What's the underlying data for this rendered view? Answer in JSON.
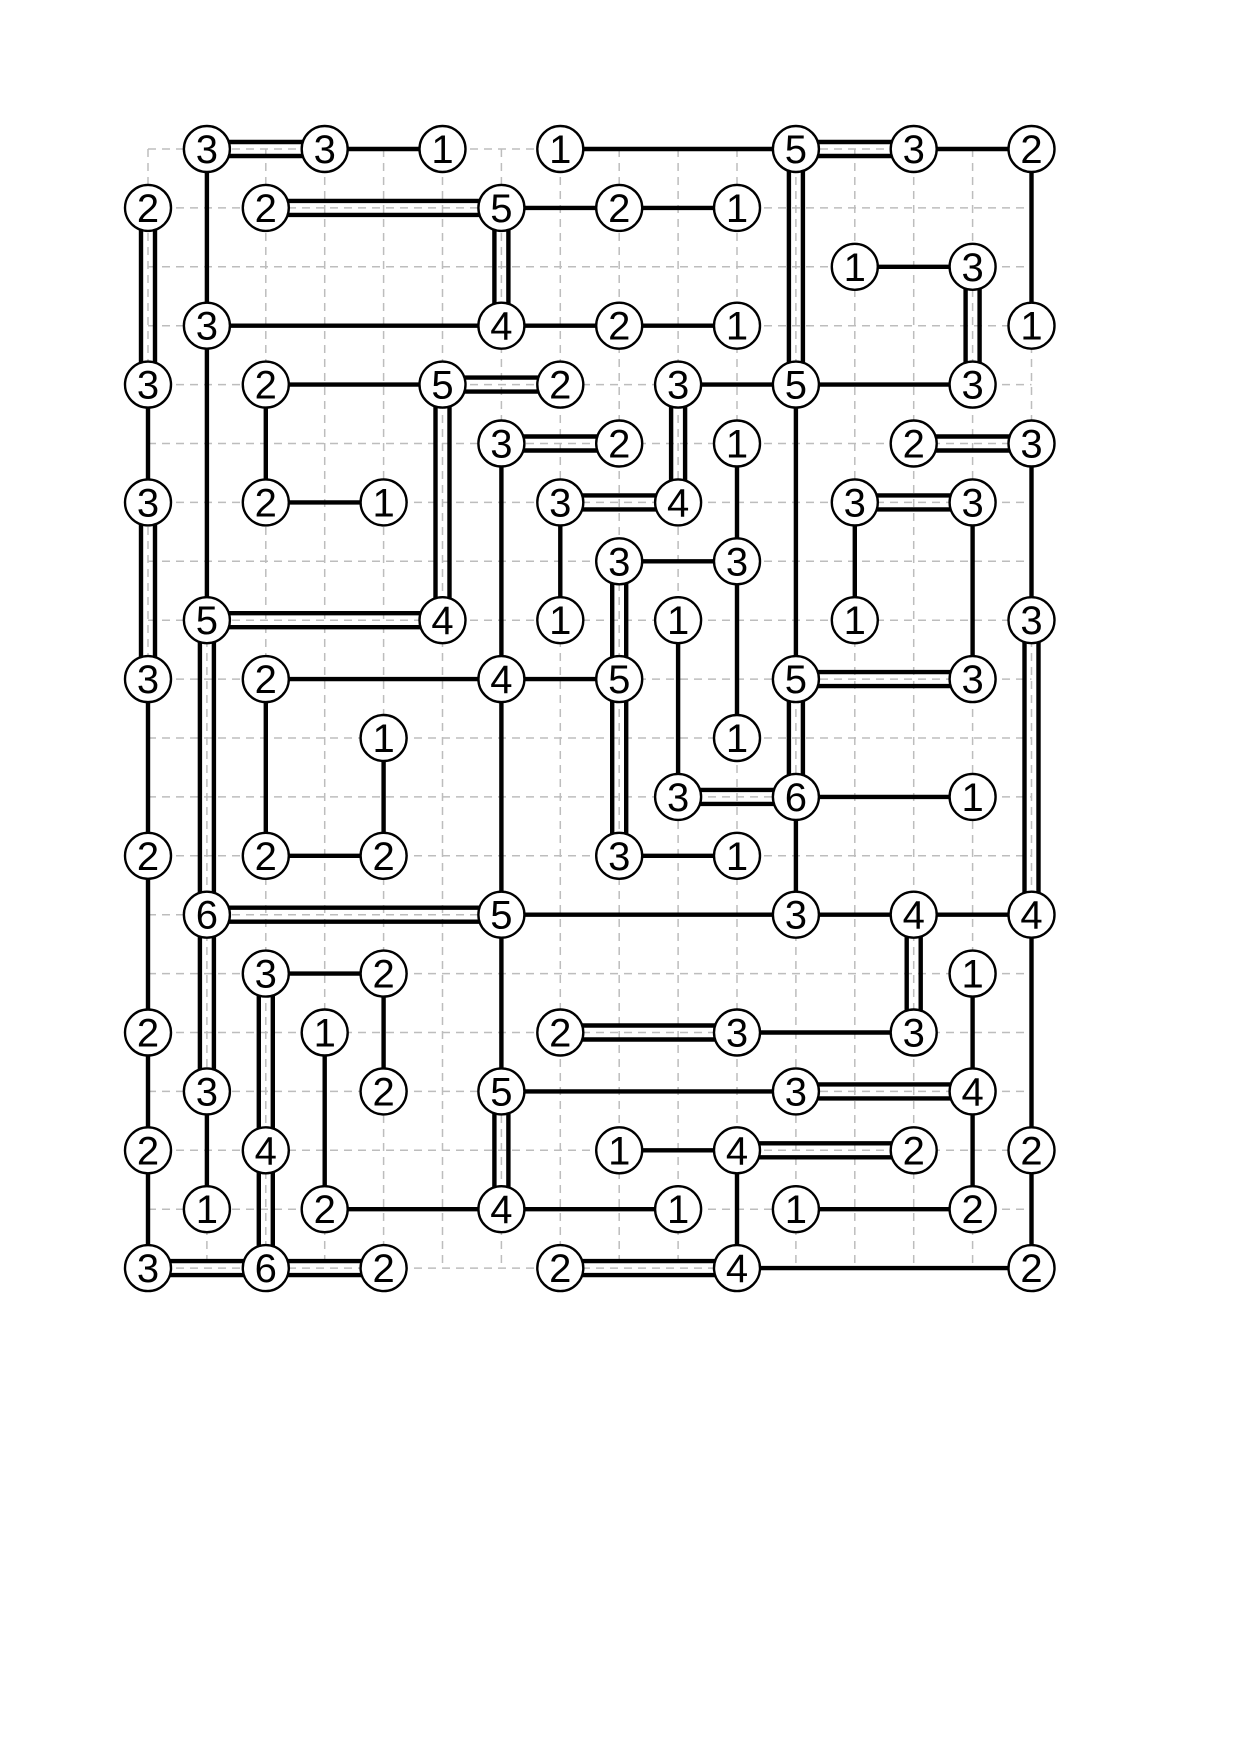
{
  "canvas": {
    "width": 1240,
    "height": 1754,
    "background": "#ffffff"
  },
  "puzzle": {
    "type": "hashiwokakero-bridges-solved",
    "grid": {
      "cols": 16,
      "rows": 20,
      "origin_x": 148,
      "origin_y": 149,
      "cell": 58.9
    },
    "style": {
      "node_fill": "#ffffff",
      "node_stroke": "#000000",
      "node_stroke_width": 2.4,
      "node_radius": 23,
      "digit_color": "#000000",
      "digit_size": 40,
      "bridge_color": "#000000",
      "bridge_width": 4.4,
      "double_gap": 14,
      "grid_color": "#bdbdbd",
      "grid_width": 1.5,
      "grid_dash": "8 6"
    },
    "nodes": [
      {
        "c": 1,
        "r": 0,
        "v": "3"
      },
      {
        "c": 3,
        "r": 0,
        "v": "3"
      },
      {
        "c": 5,
        "r": 0,
        "v": "1"
      },
      {
        "c": 7,
        "r": 0,
        "v": "1"
      },
      {
        "c": 11,
        "r": 0,
        "v": "5"
      },
      {
        "c": 13,
        "r": 0,
        "v": "3"
      },
      {
        "c": 15,
        "r": 0,
        "v": "2"
      },
      {
        "c": 0,
        "r": 1,
        "v": "2"
      },
      {
        "c": 2,
        "r": 1,
        "v": "2"
      },
      {
        "c": 6,
        "r": 1,
        "v": "5"
      },
      {
        "c": 8,
        "r": 1,
        "v": "2"
      },
      {
        "c": 10,
        "r": 1,
        "v": "1"
      },
      {
        "c": 12,
        "r": 2,
        "v": "1"
      },
      {
        "c": 14,
        "r": 2,
        "v": "3"
      },
      {
        "c": 1,
        "r": 3,
        "v": "3"
      },
      {
        "c": 6,
        "r": 3,
        "v": "4"
      },
      {
        "c": 8,
        "r": 3,
        "v": "2"
      },
      {
        "c": 10,
        "r": 3,
        "v": "1"
      },
      {
        "c": 15,
        "r": 3,
        "v": "1"
      },
      {
        "c": 0,
        "r": 4,
        "v": "3"
      },
      {
        "c": 2,
        "r": 4,
        "v": "2"
      },
      {
        "c": 5,
        "r": 4,
        "v": "5"
      },
      {
        "c": 7,
        "r": 4,
        "v": "2"
      },
      {
        "c": 9,
        "r": 4,
        "v": "3"
      },
      {
        "c": 11,
        "r": 4,
        "v": "5"
      },
      {
        "c": 14,
        "r": 4,
        "v": "3"
      },
      {
        "c": 6,
        "r": 5,
        "v": "3"
      },
      {
        "c": 8,
        "r": 5,
        "v": "2"
      },
      {
        "c": 10,
        "r": 5,
        "v": "1"
      },
      {
        "c": 13,
        "r": 5,
        "v": "2"
      },
      {
        "c": 15,
        "r": 5,
        "v": "3"
      },
      {
        "c": 0,
        "r": 6,
        "v": "3"
      },
      {
        "c": 2,
        "r": 6,
        "v": "2"
      },
      {
        "c": 4,
        "r": 6,
        "v": "1"
      },
      {
        "c": 7,
        "r": 6,
        "v": "3"
      },
      {
        "c": 9,
        "r": 6,
        "v": "4"
      },
      {
        "c": 12,
        "r": 6,
        "v": "3"
      },
      {
        "c": 14,
        "r": 6,
        "v": "3"
      },
      {
        "c": 8,
        "r": 7,
        "v": "3"
      },
      {
        "c": 10,
        "r": 7,
        "v": "3"
      },
      {
        "c": 1,
        "r": 8,
        "v": "5"
      },
      {
        "c": 5,
        "r": 8,
        "v": "4"
      },
      {
        "c": 7,
        "r": 8,
        "v": "1"
      },
      {
        "c": 9,
        "r": 8,
        "v": "1"
      },
      {
        "c": 12,
        "r": 8,
        "v": "1"
      },
      {
        "c": 15,
        "r": 8,
        "v": "3"
      },
      {
        "c": 0,
        "r": 9,
        "v": "3"
      },
      {
        "c": 2,
        "r": 9,
        "v": "2"
      },
      {
        "c": 6,
        "r": 9,
        "v": "4"
      },
      {
        "c": 8,
        "r": 9,
        "v": "5"
      },
      {
        "c": 11,
        "r": 9,
        "v": "5"
      },
      {
        "c": 14,
        "r": 9,
        "v": "3"
      },
      {
        "c": 4,
        "r": 10,
        "v": "1"
      },
      {
        "c": 10,
        "r": 10,
        "v": "1"
      },
      {
        "c": 9,
        "r": 11,
        "v": "3"
      },
      {
        "c": 11,
        "r": 11,
        "v": "6"
      },
      {
        "c": 14,
        "r": 11,
        "v": "1"
      },
      {
        "c": 0,
        "r": 12,
        "v": "2"
      },
      {
        "c": 2,
        "r": 12,
        "v": "2"
      },
      {
        "c": 4,
        "r": 12,
        "v": "2"
      },
      {
        "c": 8,
        "r": 12,
        "v": "3"
      },
      {
        "c": 10,
        "r": 12,
        "v": "1"
      },
      {
        "c": 1,
        "r": 13,
        "v": "6"
      },
      {
        "c": 6,
        "r": 13,
        "v": "5"
      },
      {
        "c": 11,
        "r": 13,
        "v": "3"
      },
      {
        "c": 13,
        "r": 13,
        "v": "4"
      },
      {
        "c": 15,
        "r": 13,
        "v": "4"
      },
      {
        "c": 2,
        "r": 14,
        "v": "3"
      },
      {
        "c": 4,
        "r": 14,
        "v": "2"
      },
      {
        "c": 14,
        "r": 14,
        "v": "1"
      },
      {
        "c": 0,
        "r": 15,
        "v": "2"
      },
      {
        "c": 3,
        "r": 15,
        "v": "1"
      },
      {
        "c": 7,
        "r": 15,
        "v": "2"
      },
      {
        "c": 10,
        "r": 15,
        "v": "3"
      },
      {
        "c": 13,
        "r": 15,
        "v": "3"
      },
      {
        "c": 1,
        "r": 16,
        "v": "3"
      },
      {
        "c": 4,
        "r": 16,
        "v": "2"
      },
      {
        "c": 6,
        "r": 16,
        "v": "5"
      },
      {
        "c": 11,
        "r": 16,
        "v": "3"
      },
      {
        "c": 14,
        "r": 16,
        "v": "4"
      },
      {
        "c": 0,
        "r": 17,
        "v": "2"
      },
      {
        "c": 2,
        "r": 17,
        "v": "4"
      },
      {
        "c": 8,
        "r": 17,
        "v": "1"
      },
      {
        "c": 10,
        "r": 17,
        "v": "4"
      },
      {
        "c": 13,
        "r": 17,
        "v": "2"
      },
      {
        "c": 15,
        "r": 17,
        "v": "2"
      },
      {
        "c": 1,
        "r": 18,
        "v": "1"
      },
      {
        "c": 3,
        "r": 18,
        "v": "2"
      },
      {
        "c": 6,
        "r": 18,
        "v": "4"
      },
      {
        "c": 9,
        "r": 18,
        "v": "1"
      },
      {
        "c": 11,
        "r": 18,
        "v": "1"
      },
      {
        "c": 14,
        "r": 18,
        "v": "2"
      },
      {
        "c": 0,
        "r": 19,
        "v": "3"
      },
      {
        "c": 2,
        "r": 19,
        "v": "6"
      },
      {
        "c": 4,
        "r": 19,
        "v": "2"
      },
      {
        "c": 7,
        "r": 19,
        "v": "2"
      },
      {
        "c": 10,
        "r": 19,
        "v": "4"
      },
      {
        "c": 15,
        "r": 19,
        "v": "2"
      }
    ],
    "bridges": [
      {
        "x1": 1,
        "y1": 0,
        "x2": 3,
        "y2": 0,
        "n": 2
      },
      {
        "x1": 3,
        "y1": 0,
        "x2": 5,
        "y2": 0,
        "n": 1
      },
      {
        "x1": 7,
        "y1": 0,
        "x2": 11,
        "y2": 0,
        "n": 1
      },
      {
        "x1": 11,
        "y1": 0,
        "x2": 13,
        "y2": 0,
        "n": 2
      },
      {
        "x1": 13,
        "y1": 0,
        "x2": 15,
        "y2": 0,
        "n": 1
      },
      {
        "x1": 2,
        "y1": 1,
        "x2": 6,
        "y2": 1,
        "n": 2
      },
      {
        "x1": 6,
        "y1": 1,
        "x2": 8,
        "y2": 1,
        "n": 1
      },
      {
        "x1": 8,
        "y1": 1,
        "x2": 10,
        "y2": 1,
        "n": 1
      },
      {
        "x1": 12,
        "y1": 2,
        "x2": 14,
        "y2": 2,
        "n": 1
      },
      {
        "x1": 1,
        "y1": 3,
        "x2": 6,
        "y2": 3,
        "n": 1
      },
      {
        "x1": 6,
        "y1": 3,
        "x2": 8,
        "y2": 3,
        "n": 1
      },
      {
        "x1": 8,
        "y1": 3,
        "x2": 10,
        "y2": 3,
        "n": 1
      },
      {
        "x1": 2,
        "y1": 4,
        "x2": 5,
        "y2": 4,
        "n": 1
      },
      {
        "x1": 5,
        "y1": 4,
        "x2": 7,
        "y2": 4,
        "n": 2
      },
      {
        "x1": 9,
        "y1": 4,
        "x2": 11,
        "y2": 4,
        "n": 1
      },
      {
        "x1": 11,
        "y1": 4,
        "x2": 14,
        "y2": 4,
        "n": 1
      },
      {
        "x1": 6,
        "y1": 5,
        "x2": 8,
        "y2": 5,
        "n": 2
      },
      {
        "x1": 13,
        "y1": 5,
        "x2": 15,
        "y2": 5,
        "n": 2
      },
      {
        "x1": 2,
        "y1": 6,
        "x2": 4,
        "y2": 6,
        "n": 1
      },
      {
        "x1": 7,
        "y1": 6,
        "x2": 9,
        "y2": 6,
        "n": 2
      },
      {
        "x1": 12,
        "y1": 6,
        "x2": 14,
        "y2": 6,
        "n": 2
      },
      {
        "x1": 8,
        "y1": 7,
        "x2": 10,
        "y2": 7,
        "n": 1
      },
      {
        "x1": 1,
        "y1": 8,
        "x2": 5,
        "y2": 8,
        "n": 2
      },
      {
        "x1": 2,
        "y1": 9,
        "x2": 6,
        "y2": 9,
        "n": 1
      },
      {
        "x1": 6,
        "y1": 9,
        "x2": 8,
        "y2": 9,
        "n": 1
      },
      {
        "x1": 11,
        "y1": 9,
        "x2": 14,
        "y2": 9,
        "n": 2
      },
      {
        "x1": 9,
        "y1": 11,
        "x2": 11,
        "y2": 11,
        "n": 2
      },
      {
        "x1": 11,
        "y1": 11,
        "x2": 14,
        "y2": 11,
        "n": 1
      },
      {
        "x1": 2,
        "y1": 12,
        "x2": 4,
        "y2": 12,
        "n": 1
      },
      {
        "x1": 8,
        "y1": 12,
        "x2": 10,
        "y2": 12,
        "n": 1
      },
      {
        "x1": 1,
        "y1": 13,
        "x2": 6,
        "y2": 13,
        "n": 2
      },
      {
        "x1": 6,
        "y1": 13,
        "x2": 11,
        "y2": 13,
        "n": 1
      },
      {
        "x1": 11,
        "y1": 13,
        "x2": 13,
        "y2": 13,
        "n": 1
      },
      {
        "x1": 13,
        "y1": 13,
        "x2": 15,
        "y2": 13,
        "n": 1
      },
      {
        "x1": 2,
        "y1": 14,
        "x2": 4,
        "y2": 14,
        "n": 1
      },
      {
        "x1": 7,
        "y1": 15,
        "x2": 10,
        "y2": 15,
        "n": 2
      },
      {
        "x1": 10,
        "y1": 15,
        "x2": 13,
        "y2": 15,
        "n": 1
      },
      {
        "x1": 6,
        "y1": 16,
        "x2": 11,
        "y2": 16,
        "n": 1
      },
      {
        "x1": 11,
        "y1": 16,
        "x2": 14,
        "y2": 16,
        "n": 2
      },
      {
        "x1": 8,
        "y1": 17,
        "x2": 10,
        "y2": 17,
        "n": 1
      },
      {
        "x1": 10,
        "y1": 17,
        "x2": 13,
        "y2": 17,
        "n": 2
      },
      {
        "x1": 3,
        "y1": 18,
        "x2": 6,
        "y2": 18,
        "n": 1
      },
      {
        "x1": 6,
        "y1": 18,
        "x2": 9,
        "y2": 18,
        "n": 1
      },
      {
        "x1": 11,
        "y1": 18,
        "x2": 14,
        "y2": 18,
        "n": 1
      },
      {
        "x1": 0,
        "y1": 19,
        "x2": 2,
        "y2": 19,
        "n": 2
      },
      {
        "x1": 2,
        "y1": 19,
        "x2": 4,
        "y2": 19,
        "n": 2
      },
      {
        "x1": 7,
        "y1": 19,
        "x2": 10,
        "y2": 19,
        "n": 2
      },
      {
        "x1": 10,
        "y1": 19,
        "x2": 15,
        "y2": 19,
        "n": 1
      },
      {
        "x1": 0,
        "y1": 1,
        "x2": 0,
        "y2": 4,
        "n": 2
      },
      {
        "x1": 0,
        "y1": 4,
        "x2": 0,
        "y2": 6,
        "n": 1
      },
      {
        "x1": 0,
        "y1": 6,
        "x2": 0,
        "y2": 9,
        "n": 2
      },
      {
        "x1": 0,
        "y1": 9,
        "x2": 0,
        "y2": 12,
        "n": 1
      },
      {
        "x1": 0,
        "y1": 12,
        "x2": 0,
        "y2": 15,
        "n": 1
      },
      {
        "x1": 0,
        "y1": 15,
        "x2": 0,
        "y2": 17,
        "n": 1
      },
      {
        "x1": 0,
        "y1": 17,
        "x2": 0,
        "y2": 19,
        "n": 1
      },
      {
        "x1": 1,
        "y1": 0,
        "x2": 1,
        "y2": 3,
        "n": 1
      },
      {
        "x1": 1,
        "y1": 3,
        "x2": 1,
        "y2": 8,
        "n": 1
      },
      {
        "x1": 1,
        "y1": 8,
        "x2": 1,
        "y2": 13,
        "n": 2
      },
      {
        "x1": 1,
        "y1": 13,
        "x2": 1,
        "y2": 16,
        "n": 2
      },
      {
        "x1": 1,
        "y1": 16,
        "x2": 1,
        "y2": 18,
        "n": 1
      },
      {
        "x1": 2,
        "y1": 4,
        "x2": 2,
        "y2": 6,
        "n": 1
      },
      {
        "x1": 2,
        "y1": 9,
        "x2": 2,
        "y2": 12,
        "n": 1
      },
      {
        "x1": 2,
        "y1": 14,
        "x2": 2,
        "y2": 17,
        "n": 2
      },
      {
        "x1": 2,
        "y1": 17,
        "x2": 2,
        "y2": 19,
        "n": 2
      },
      {
        "x1": 3,
        "y1": 15,
        "x2": 3,
        "y2": 18,
        "n": 1
      },
      {
        "x1": 4,
        "y1": 10,
        "x2": 4,
        "y2": 12,
        "n": 1
      },
      {
        "x1": 4,
        "y1": 14,
        "x2": 4,
        "y2": 16,
        "n": 1
      },
      {
        "x1": 5,
        "y1": 4,
        "x2": 5,
        "y2": 8,
        "n": 2
      },
      {
        "x1": 6,
        "y1": 1,
        "x2": 6,
        "y2": 3,
        "n": 2
      },
      {
        "x1": 6,
        "y1": 5,
        "x2": 6,
        "y2": 9,
        "n": 1
      },
      {
        "x1": 6,
        "y1": 9,
        "x2": 6,
        "y2": 13,
        "n": 1
      },
      {
        "x1": 6,
        "y1": 13,
        "x2": 6,
        "y2": 16,
        "n": 1
      },
      {
        "x1": 6,
        "y1": 16,
        "x2": 6,
        "y2": 18,
        "n": 2
      },
      {
        "x1": 7,
        "y1": 6,
        "x2": 7,
        "y2": 8,
        "n": 1
      },
      {
        "x1": 8,
        "y1": 7,
        "x2": 8,
        "y2": 9,
        "n": 2
      },
      {
        "x1": 8,
        "y1": 9,
        "x2": 8,
        "y2": 12,
        "n": 2
      },
      {
        "x1": 9,
        "y1": 4,
        "x2": 9,
        "y2": 6,
        "n": 2
      },
      {
        "x1": 9,
        "y1": 8,
        "x2": 9,
        "y2": 11,
        "n": 1
      },
      {
        "x1": 10,
        "y1": 5,
        "x2": 10,
        "y2": 7,
        "n": 1
      },
      {
        "x1": 10,
        "y1": 7,
        "x2": 10,
        "y2": 10,
        "n": 1
      },
      {
        "x1": 10,
        "y1": 17,
        "x2": 10,
        "y2": 19,
        "n": 1
      },
      {
        "x1": 11,
        "y1": 0,
        "x2": 11,
        "y2": 4,
        "n": 2
      },
      {
        "x1": 11,
        "y1": 4,
        "x2": 11,
        "y2": 9,
        "n": 1
      },
      {
        "x1": 11,
        "y1": 9,
        "x2": 11,
        "y2": 11,
        "n": 2
      },
      {
        "x1": 11,
        "y1": 11,
        "x2": 11,
        "y2": 13,
        "n": 1
      },
      {
        "x1": 12,
        "y1": 6,
        "x2": 12,
        "y2": 8,
        "n": 1
      },
      {
        "x1": 13,
        "y1": 13,
        "x2": 13,
        "y2": 15,
        "n": 2
      },
      {
        "x1": 14,
        "y1": 2,
        "x2": 14,
        "y2": 4,
        "n": 2
      },
      {
        "x1": 14,
        "y1": 6,
        "x2": 14,
        "y2": 9,
        "n": 1
      },
      {
        "x1": 14,
        "y1": 14,
        "x2": 14,
        "y2": 16,
        "n": 1
      },
      {
        "x1": 14,
        "y1": 16,
        "x2": 14,
        "y2": 18,
        "n": 1
      },
      {
        "x1": 15,
        "y1": 0,
        "x2": 15,
        "y2": 3,
        "n": 1
      },
      {
        "x1": 15,
        "y1": 5,
        "x2": 15,
        "y2": 8,
        "n": 1
      },
      {
        "x1": 15,
        "y1": 8,
        "x2": 15,
        "y2": 13,
        "n": 2
      },
      {
        "x1": 15,
        "y1": 13,
        "x2": 15,
        "y2": 17,
        "n": 1
      },
      {
        "x1": 15,
        "y1": 17,
        "x2": 15,
        "y2": 19,
        "n": 1
      }
    ]
  }
}
